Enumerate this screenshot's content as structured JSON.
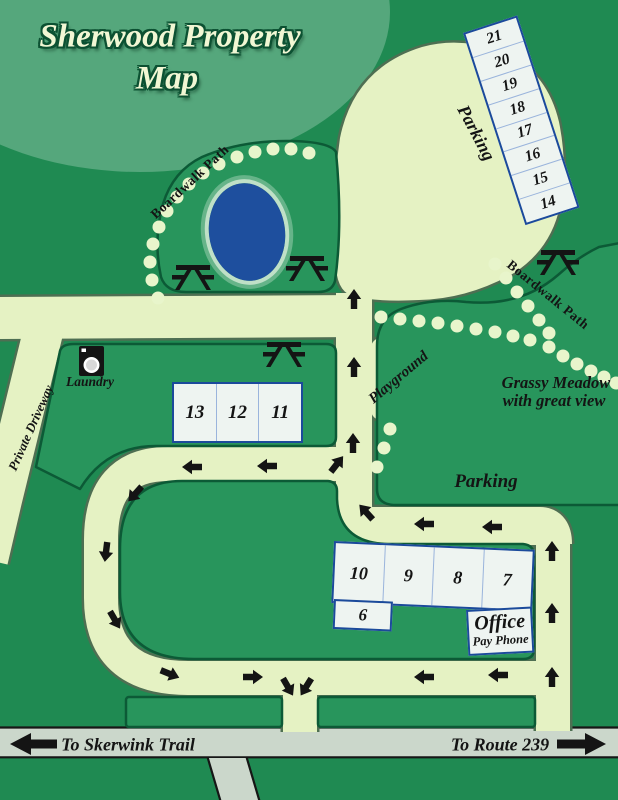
{
  "title": {
    "line1": "Sherwood Property",
    "line2": "Map"
  },
  "labels": {
    "parking_top": "Parking",
    "parking_lot": "Parking",
    "boardwalk_left": "Boardwalk Path",
    "boardwalk_right": "Boardwalk Path",
    "laundry": "Laundry",
    "private_driveway": "Private Driveway",
    "playground": "Playground",
    "grassy_meadow_1": "Grassy Meadow",
    "grassy_meadow_2": "with great view",
    "office": "Office",
    "pay_phone": "Pay Phone",
    "to_skerwink": "To Skerwink Trail",
    "to_route": "To Route 239"
  },
  "sites": {
    "strip": [
      "21",
      "20",
      "19",
      "18",
      "17",
      "16",
      "15",
      "14"
    ],
    "row_upper": [
      "13",
      "12",
      "11"
    ],
    "row_lower": [
      "10",
      "9",
      "8",
      "7"
    ],
    "single": "6"
  },
  "colors": {
    "background_green": "#1f8a52",
    "title_ellipse_green": "#55a77c",
    "island_green": "#28955c",
    "island_outline": "#0c5a36",
    "road_cream": "#e5f2c3",
    "road_casing": "#4e6f52",
    "public_road_gray": "#cbd7cb",
    "pond_blue": "#1e4f9e",
    "site_box_fill": "#eef4f1",
    "site_box_border": "#1b4a9b",
    "site_box_divider": "#9ab4dc",
    "title_cream": "#f1f7d4",
    "ink_black": "#141414"
  },
  "map_features": {
    "dots_left_trail": [
      [
        158,
        298
      ],
      [
        152,
        280
      ],
      [
        150,
        262
      ],
      [
        153,
        244
      ],
      [
        159,
        227
      ],
      [
        167,
        211
      ],
      [
        177,
        197
      ],
      [
        189,
        184
      ],
      [
        203,
        173
      ],
      [
        219,
        164
      ],
      [
        237,
        157
      ],
      [
        255,
        152
      ],
      [
        273,
        149
      ],
      [
        291,
        149
      ],
      [
        309,
        153
      ]
    ],
    "dots_right_lower": [
      [
        381,
        317
      ],
      [
        400,
        319
      ],
      [
        419,
        321
      ],
      [
        438,
        323
      ],
      [
        457,
        326
      ],
      [
        476,
        329
      ],
      [
        495,
        332
      ],
      [
        513,
        336
      ],
      [
        530,
        340
      ]
    ],
    "dots_right_upper": [
      [
        495,
        264
      ],
      [
        506,
        278
      ],
      [
        517,
        292
      ],
      [
        528,
        306
      ],
      [
        539,
        320
      ],
      [
        549,
        333
      ]
    ],
    "dots_right_merged": [
      [
        549,
        347
      ],
      [
        563,
        356
      ],
      [
        577,
        364
      ],
      [
        591,
        371
      ],
      [
        604,
        377
      ],
      [
        616,
        383
      ]
    ],
    "dots_playground": [
      [
        390,
        429
      ],
      [
        384,
        448
      ],
      [
        377,
        467
      ]
    ],
    "picnic_tables": [
      [
        193,
        277
      ],
      [
        307,
        268
      ],
      [
        284,
        354
      ],
      [
        558,
        262
      ]
    ],
    "flow_arrows": [
      [
        354,
        299,
        0
      ],
      [
        354,
        367,
        0
      ],
      [
        353,
        443,
        0
      ],
      [
        366,
        512,
        -42
      ],
      [
        424,
        524,
        -90
      ],
      [
        492,
        527,
        -90
      ],
      [
        552,
        551,
        0
      ],
      [
        552,
        613,
        0
      ],
      [
        552,
        677,
        0
      ],
      [
        337,
        464,
        38
      ],
      [
        267,
        466,
        -90
      ],
      [
        192,
        467,
        -90
      ],
      [
        135,
        494,
        222
      ],
      [
        106,
        552,
        187
      ],
      [
        115,
        620,
        150
      ],
      [
        170,
        674,
        112
      ],
      [
        253,
        677,
        90
      ],
      [
        288,
        687,
        150
      ],
      [
        306,
        687,
        212
      ],
      [
        424,
        677,
        -90
      ],
      [
        498,
        675,
        -90
      ]
    ]
  }
}
